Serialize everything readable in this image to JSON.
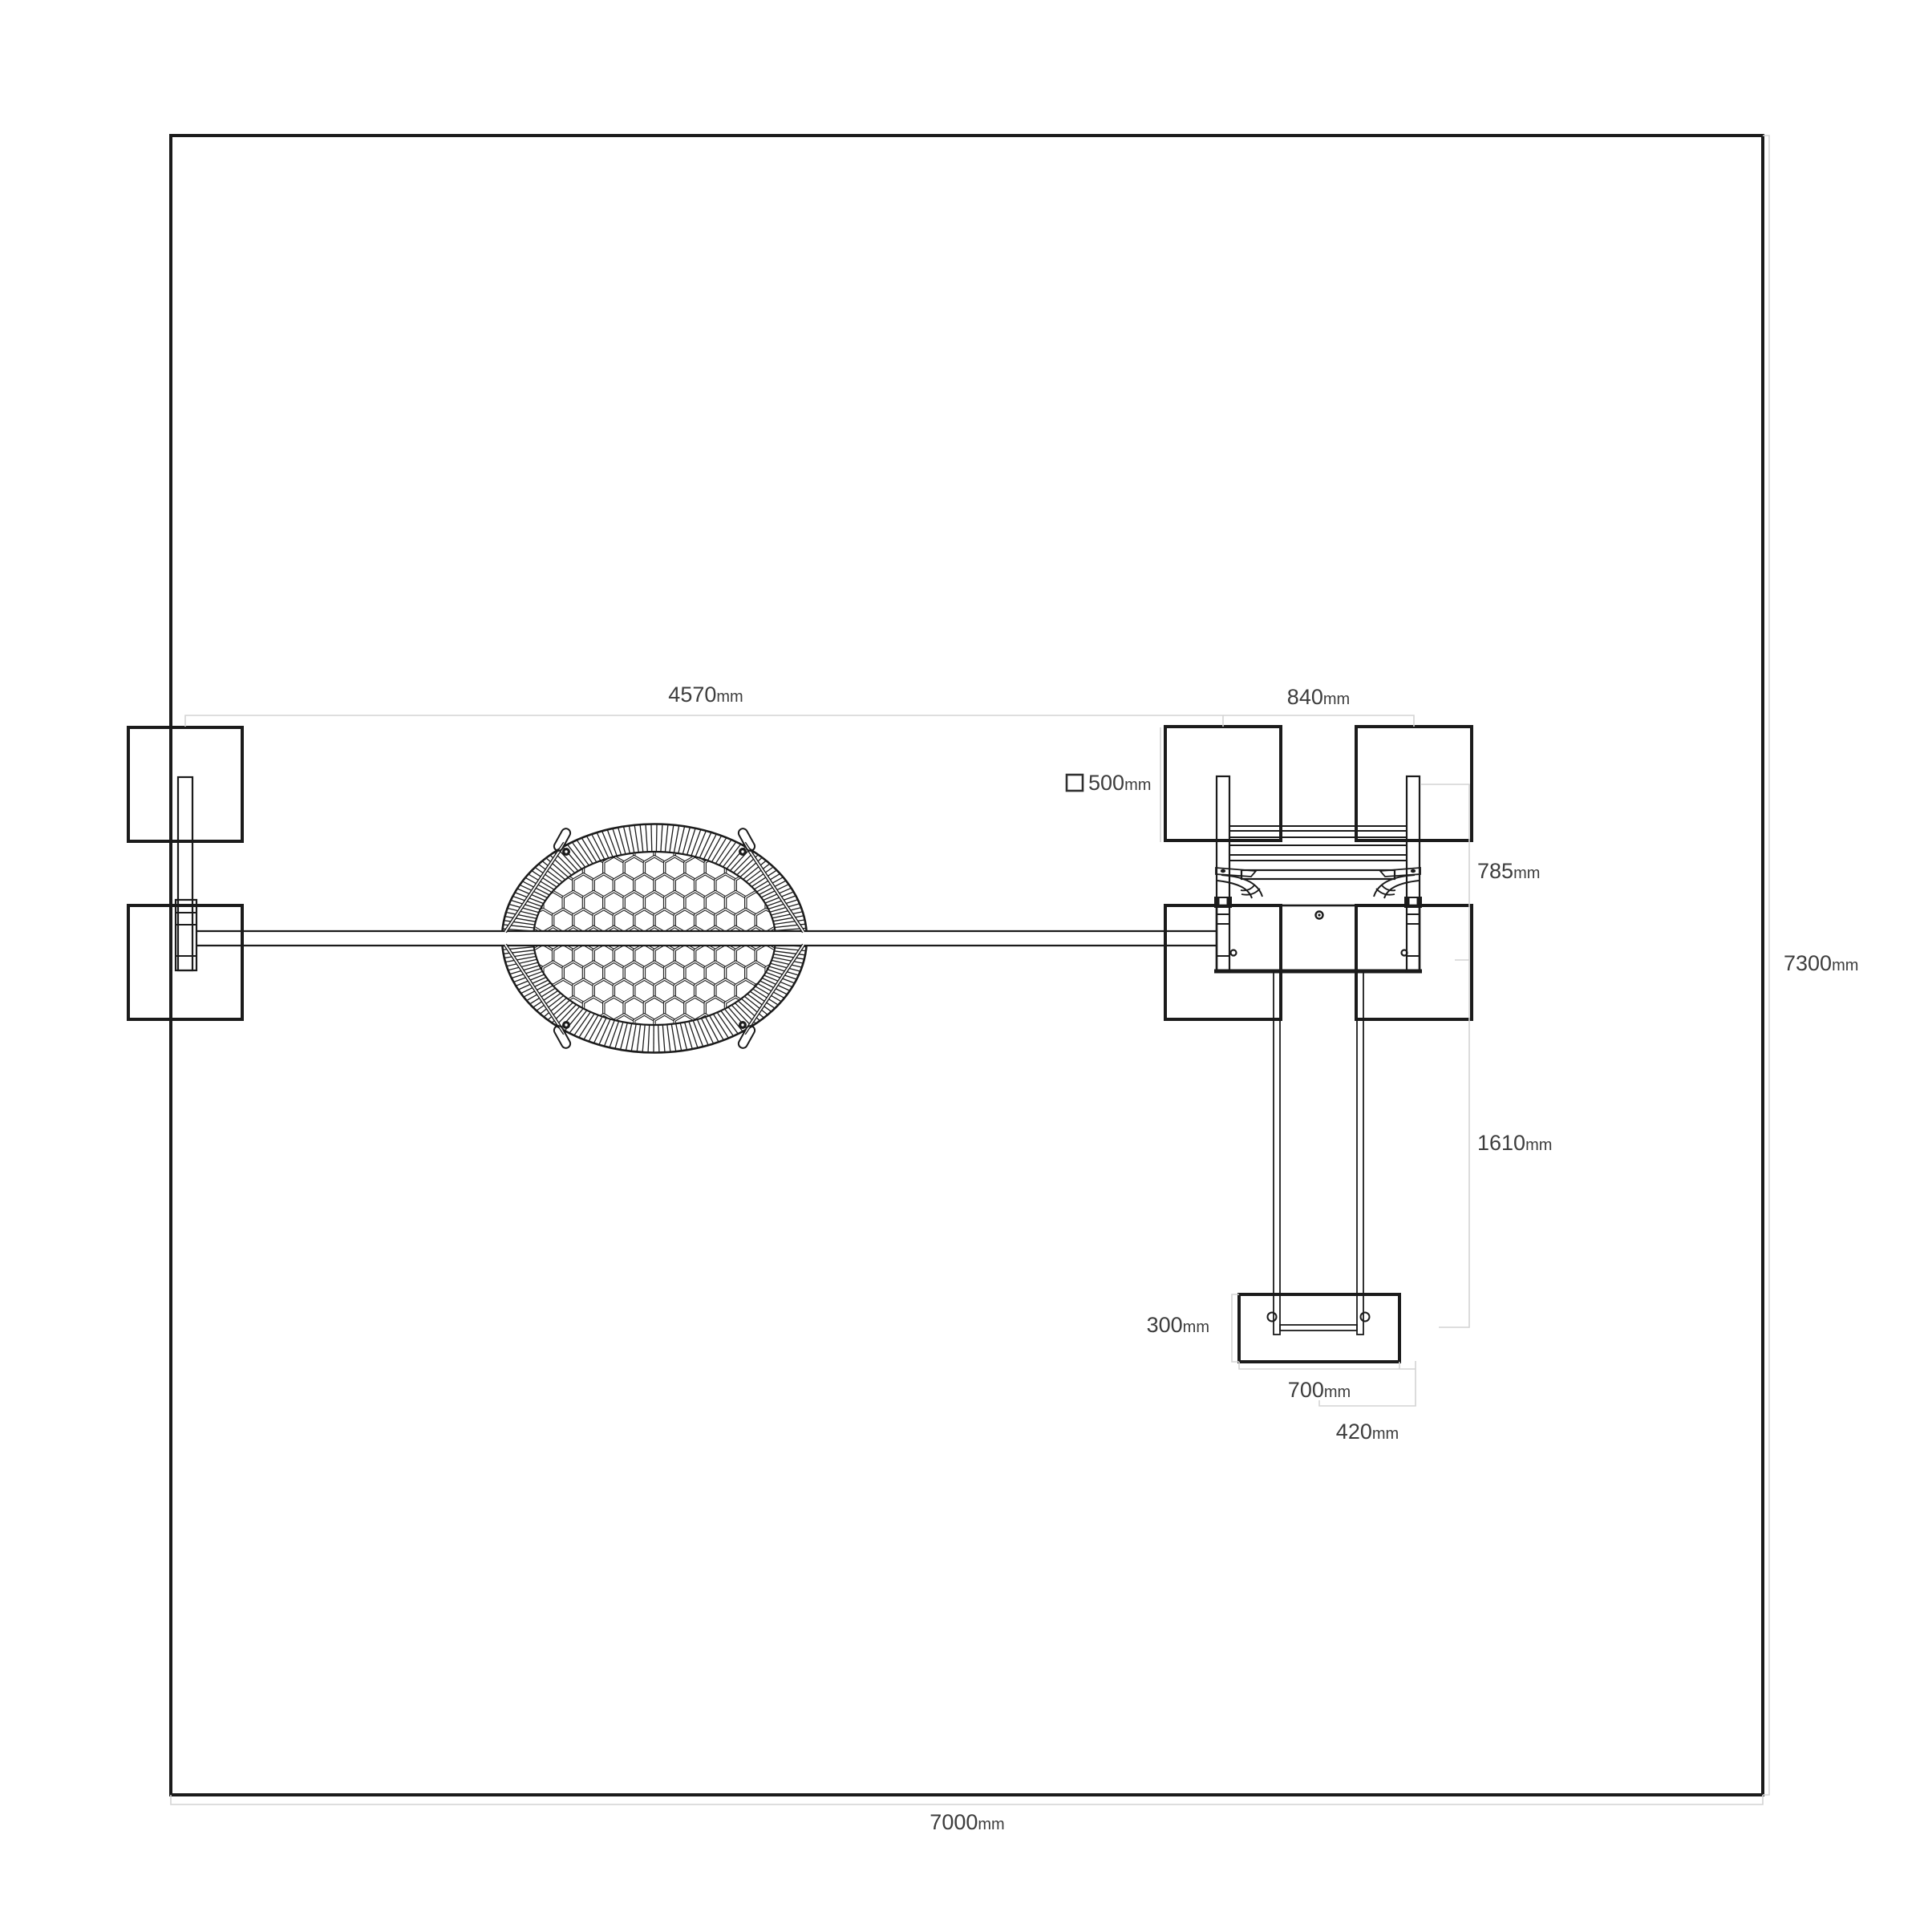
{
  "drawing": {
    "background": "#ffffff",
    "description_labels_unit": "mm"
  },
  "colors": {
    "line": "#1b1b1b",
    "dim_line": "#d4d4d4",
    "dim_text": "#3d3d3d",
    "background": "#ffffff"
  },
  "dimensions": {
    "beam_span": {
      "value": "4570",
      "unit": "mm"
    },
    "post_spacing": {
      "value": "840",
      "unit": "mm"
    },
    "footing_size": {
      "value": "500",
      "unit": "mm"
    },
    "frame_depth": {
      "value": "785",
      "unit": "mm"
    },
    "site_height": {
      "value": "7300",
      "unit": "mm"
    },
    "drop_length": {
      "value": "1610",
      "unit": "mm"
    },
    "pad_depth": {
      "value": "300",
      "unit": "mm"
    },
    "pad_width": {
      "value": "700",
      "unit": "mm"
    },
    "pad_offset": {
      "value": "420",
      "unit": "mm"
    },
    "site_width": {
      "value": "7000",
      "unit": "mm"
    }
  }
}
